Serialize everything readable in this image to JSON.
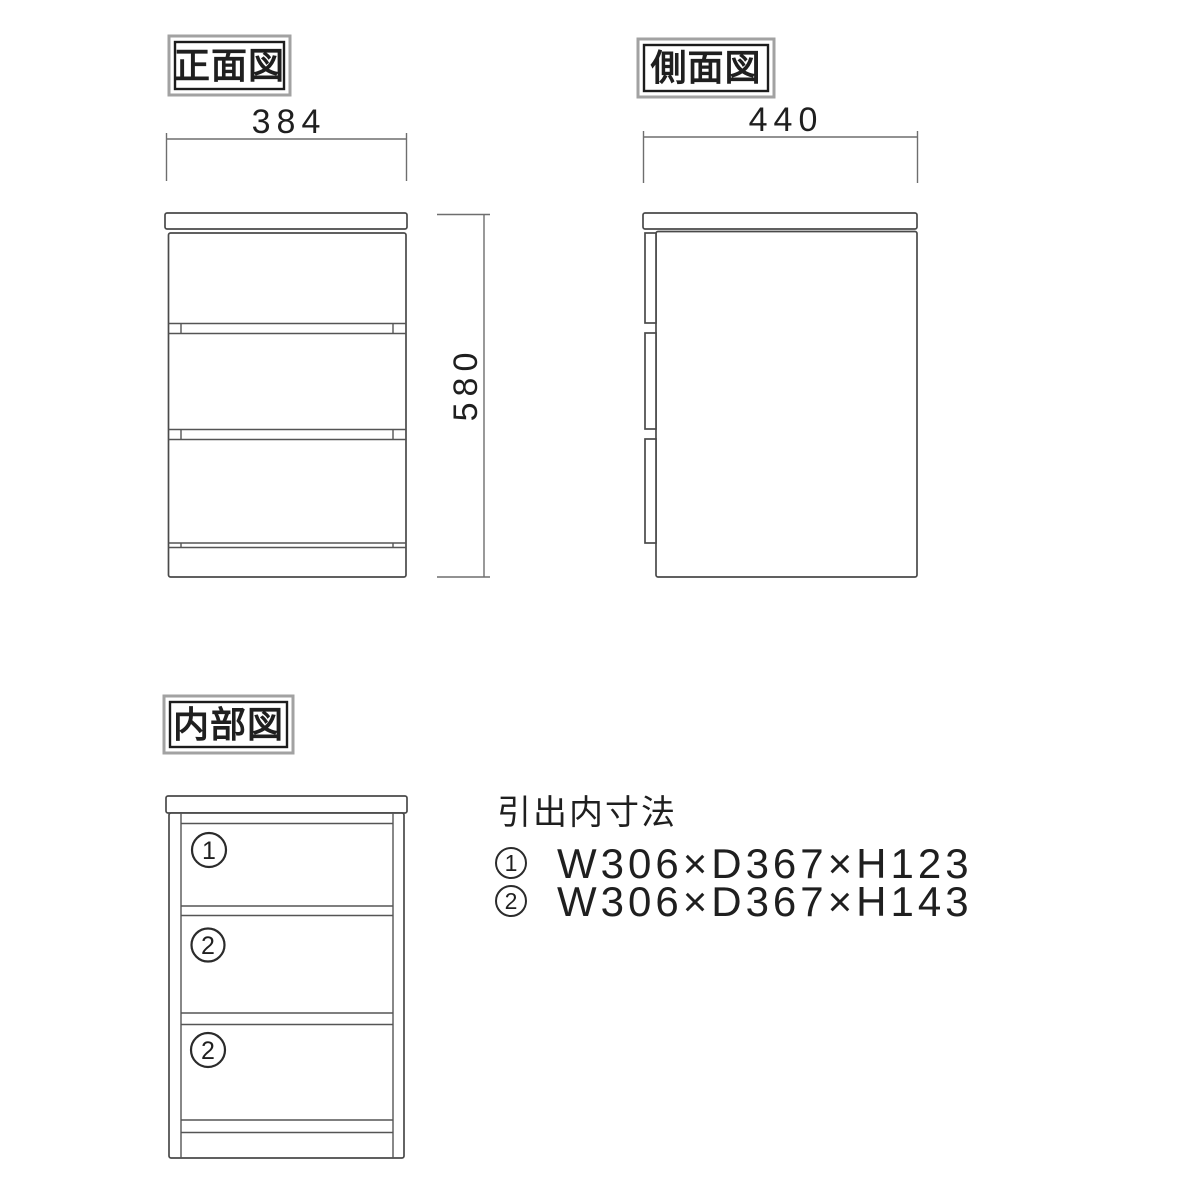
{
  "colors": {
    "background": "#ffffff",
    "line": "#4a4a4a",
    "dimension_line": "#6e6e6e",
    "text": "#1f1f1f",
    "label_box_outer": "#a2a2a2",
    "label_box_inner": "#1c1c1c"
  },
  "views": {
    "front": {
      "label": "正面図",
      "width_dim": "384",
      "height_dim": "580"
    },
    "side": {
      "label": "側面図",
      "depth_dim": "440"
    },
    "internal": {
      "label": "内部図",
      "compartment_labels": [
        "1",
        "2",
        "2"
      ]
    }
  },
  "drawer_spec": {
    "title": "引出内寸法",
    "items": [
      {
        "num": "1",
        "dims": "W306×D367×H123"
      },
      {
        "num": "2",
        "dims": "W306×D367×H143"
      }
    ]
  }
}
